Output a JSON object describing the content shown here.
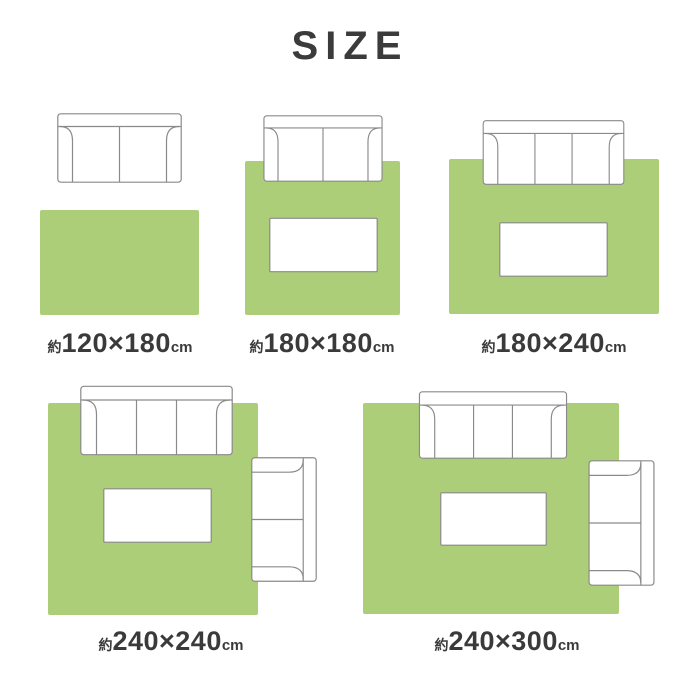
{
  "title": "SIZE",
  "colors": {
    "rug_green": "#adce78",
    "outline_gray": "#8a8a8a",
    "text_dark": "#3a3a3a"
  },
  "sizes": [
    {
      "id": "120x180",
      "prefix": "約",
      "dimensions": "120×180",
      "unit": "cm",
      "furniture": [
        "two-seat-sofa"
      ]
    },
    {
      "id": "180x180",
      "prefix": "約",
      "dimensions": "180×180",
      "unit": "cm",
      "furniture": [
        "two-seat-sofa",
        "table"
      ]
    },
    {
      "id": "180x240",
      "prefix": "約",
      "dimensions": "180×240",
      "unit": "cm",
      "furniture": [
        "three-seat-sofa",
        "table"
      ]
    },
    {
      "id": "240x240",
      "prefix": "約",
      "dimensions": "240×240",
      "unit": "cm",
      "furniture": [
        "three-seat-sofa",
        "side-two-seat-sofa",
        "table"
      ]
    },
    {
      "id": "240x300",
      "prefix": "約",
      "dimensions": "240×300",
      "unit": "cm",
      "furniture": [
        "three-seat-sofa",
        "side-two-seat-sofa",
        "table"
      ]
    }
  ]
}
